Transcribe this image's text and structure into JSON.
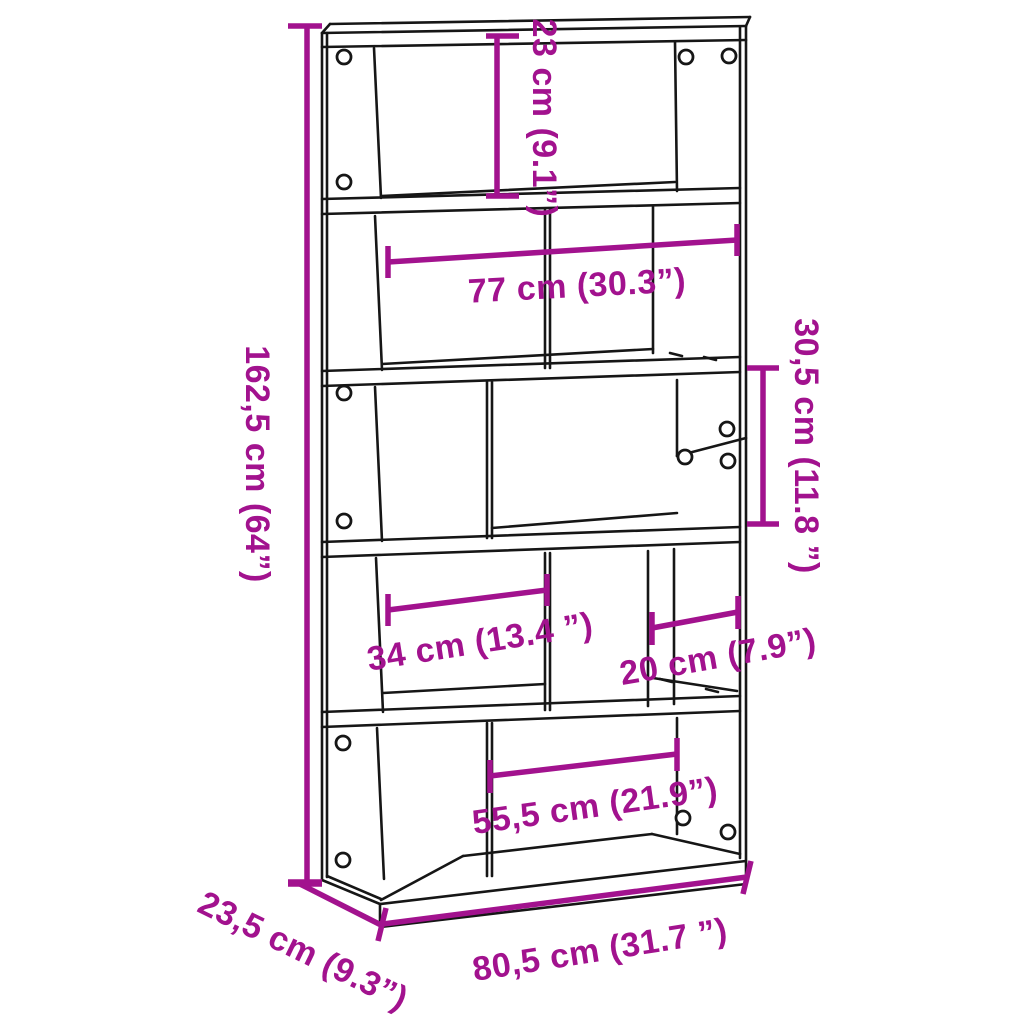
{
  "diagram": {
    "product": "5-tier bookcase room-divider dimension drawing",
    "style": {
      "accent_color": "#A2128E",
      "line_color": "#161616",
      "background": "#FFFFFF"
    },
    "dimensions": {
      "total_height": "162,5 cm (64”)",
      "top_compartment_height": "23 cm (9.1”)",
      "inner_width": "77 cm (30.3”)",
      "compartment_height": "30,5 cm (11.8 ”)",
      "left_compartment_width": "34 cm (13.4 ”)",
      "right_compartment_width": "20 cm (7.9”)",
      "bottom_compartment_width": "55,5 cm (21.9”)",
      "total_width": "80,5 cm (31.7 ”)",
      "depth": "23,5 cm (9.3”)"
    }
  }
}
